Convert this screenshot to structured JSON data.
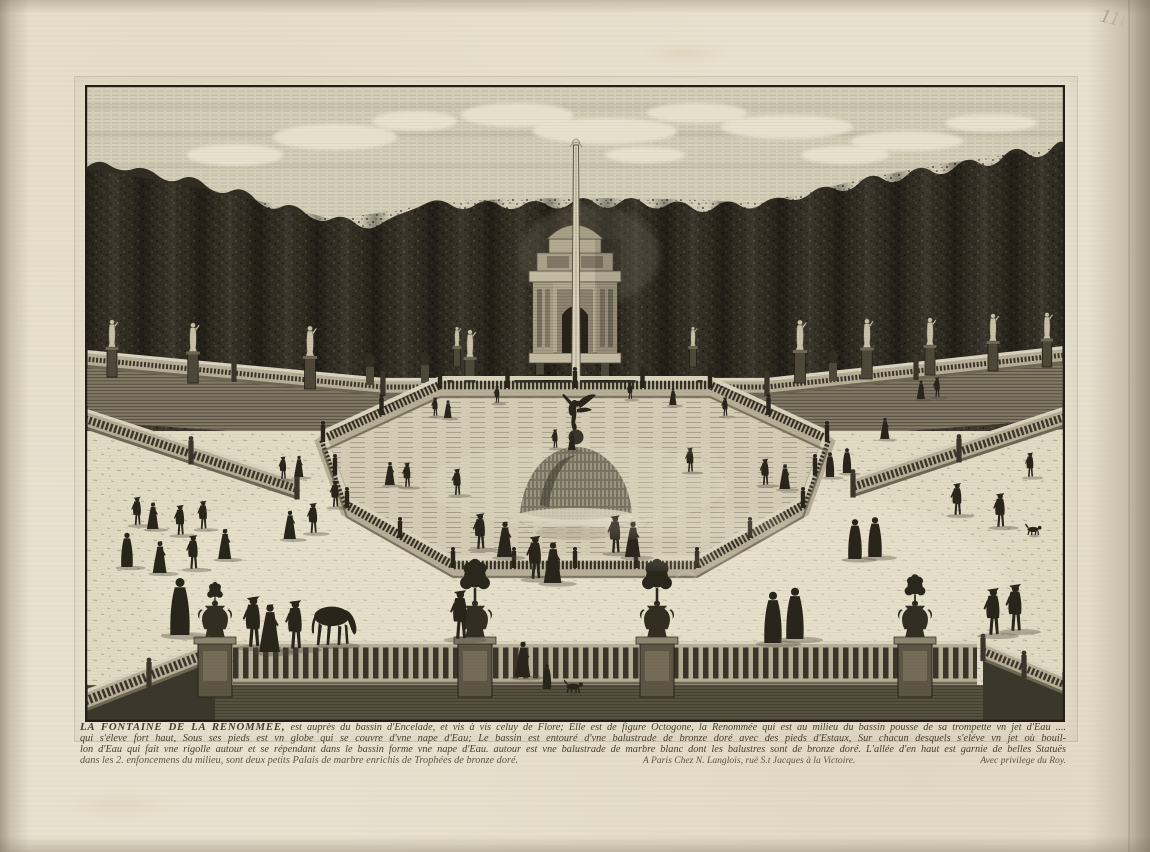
{
  "artwork": {
    "caption": {
      "line1_lead": "LA FONTAINE DE LA RENOMMEE,",
      "line1_rest": "est auprès du bassin d'Encelade, et vis à vis celuy de Flore; Elle est de figure Octogone, la Renommée qui est au milieu du bassin pousse de sa trompette vn jet d'Eau ....",
      "line2": "qui s'éleve fort haut, Sous ses pieds est vn globe qui se couvre d'vne nape d'Eau; Le bassin est entouré d'vne balustrade de bronze doré avec des pieds d'Estaux, Sur chacun desquels s'eléve vn jet où bouil-",
      "line3": "lon d'Eau qui fait vne rigolle autour et se répendant dans le bassin forme vne nape d'Eau. autour est vne balustrade de marbre blanc dont les balustres sont de bronze doré. L'allée d'en haut est garnie de belles Statuës",
      "line4": "dans les 2. enfoncemens du milieu, sont deux petits Palais de marbre enrichis de Trophées de bronze doré.",
      "publisher": "A Paris Chez N. Langlois, ruë S.t Jacques à la Victoire.",
      "privilege": "Avec privilege du Roy."
    },
    "page_number": "116",
    "watermark_symbol": "©",
    "colors": {
      "paper": "#e8e1cf",
      "plate_paper": "#e4ddc7",
      "ink": "#2a251b",
      "ink_soft": "#3a342a",
      "hedge": "#322d23",
      "sky": "#d6cfb9",
      "cloud": "#eae4d1",
      "stone_light": "#c8bfa7",
      "stone_base": "#b7ae97",
      "coping": "#dad3be",
      "water": "#d4ccb4",
      "walkway": "#e2dbc4",
      "wall": "#837a66",
      "shadow": "#4c463a",
      "marble_statue": "#c9c0a8",
      "pencil": "#958d7b",
      "dome": "#7b7362",
      "foliage": "#2b261c"
    }
  },
  "scene": {
    "clouds": [
      [
        150,
        70,
        48,
        11
      ],
      [
        250,
        52,
        62,
        13
      ],
      [
        330,
        36,
        42,
        10
      ],
      [
        432,
        30,
        56,
        12
      ],
      [
        520,
        46,
        72,
        13
      ],
      [
        612,
        28,
        50,
        10
      ],
      [
        702,
        42,
        66,
        12
      ],
      [
        822,
        56,
        56,
        10
      ],
      [
        906,
        38,
        46,
        9
      ],
      [
        560,
        70,
        40,
        8
      ],
      [
        760,
        70,
        44,
        9
      ]
    ],
    "rails_far": [
      [
        0,
        274,
        298,
        302,
        12,
        "2 1.7"
      ],
      [
        298,
        302,
        432,
        302,
        12,
        "2 1.7"
      ],
      [
        548,
        302,
        682,
        302,
        12,
        "2 1.7"
      ],
      [
        682,
        302,
        980,
        270,
        12,
        "2 1.7"
      ]
    ],
    "rails_near": [
      [
        0,
        334,
        212,
        404,
        15,
        "2.4 2"
      ],
      [
        980,
        332,
        768,
        402,
        15,
        "2.4 2"
      ]
    ],
    "rails_fg": [
      [
        148,
        578,
        892,
        578,
        38,
        "5.5 4.5",
        0
      ],
      [
        0,
        616,
        128,
        566,
        16,
        "2.6 2.2",
        1
      ],
      [
        898,
        566,
        980,
        600,
        14,
        "2.4 2",
        1
      ]
    ],
    "basin": [
      [
        355,
        302
      ],
      [
        625,
        302
      ],
      [
        742,
        356
      ],
      [
        718,
        422
      ],
      [
        612,
        482
      ],
      [
        368,
        482
      ],
      [
        262,
        422
      ],
      [
        238,
        356
      ]
    ],
    "statues": [
      [
        27,
        292,
        1.0
      ],
      [
        108,
        298,
        1.05
      ],
      [
        225,
        304,
        1.1
      ],
      [
        385,
        302,
        1.0
      ],
      [
        455,
        290,
        0.85
      ],
      [
        372,
        282,
        0.7
      ],
      [
        608,
        282,
        0.7
      ],
      [
        715,
        298,
        1.1
      ],
      [
        782,
        294,
        1.05
      ],
      [
        845,
        290,
        1.0
      ],
      [
        908,
        286,
        1.0
      ],
      [
        962,
        282,
        0.95
      ]
    ],
    "urnposts": [
      [
        285,
        300
      ],
      [
        340,
        298
      ],
      [
        520,
        292
      ],
      [
        748,
        296
      ]
    ],
    "piers": [
      [
        130,
        "plant"
      ],
      [
        390,
        "tree"
      ],
      [
        572,
        "tree"
      ],
      [
        830,
        "shrub"
      ]
    ],
    "figures": [
      [
        350,
        331,
        20,
        "m"
      ],
      [
        363,
        333,
        20,
        "w"
      ],
      [
        412,
        318,
        18,
        "m"
      ],
      [
        545,
        314,
        18,
        "m"
      ],
      [
        588,
        320,
        19,
        "w"
      ],
      [
        640,
        331,
        20,
        "m"
      ],
      [
        470,
        363,
        20,
        "m"
      ],
      [
        487,
        365,
        20,
        "w"
      ],
      [
        836,
        314,
        21,
        "w"
      ],
      [
        852,
        312,
        21,
        "m"
      ],
      [
        800,
        354,
        24,
        "w"
      ],
      [
        945,
        392,
        26,
        "m"
      ],
      [
        198,
        394,
        24,
        "m"
      ],
      [
        214,
        392,
        24,
        "w"
      ],
      [
        305,
        400,
        26,
        "w"
      ],
      [
        322,
        402,
        26,
        "m"
      ],
      [
        250,
        422,
        28,
        "m"
      ],
      [
        605,
        387,
        26,
        "m"
      ],
      [
        680,
        400,
        28,
        "m"
      ],
      [
        700,
        404,
        28,
        "w"
      ],
      [
        745,
        392,
        26,
        "c"
      ],
      [
        762,
        388,
        26,
        "c"
      ],
      [
        52,
        440,
        30,
        "m"
      ],
      [
        68,
        444,
        30,
        "w"
      ],
      [
        95,
        450,
        32,
        "m"
      ],
      [
        118,
        444,
        30,
        "m"
      ],
      [
        42,
        482,
        36,
        "c"
      ],
      [
        75,
        488,
        36,
        "w"
      ],
      [
        108,
        484,
        36,
        "m"
      ],
      [
        140,
        474,
        34,
        "w"
      ],
      [
        205,
        454,
        32,
        "w"
      ],
      [
        228,
        448,
        32,
        "m"
      ],
      [
        372,
        410,
        28,
        "m"
      ],
      [
        872,
        430,
        34,
        "m"
      ],
      [
        915,
        442,
        36,
        "m"
      ],
      [
        948,
        450,
        12,
        "d"
      ],
      [
        530,
        468,
        40,
        "m"
      ],
      [
        548,
        472,
        40,
        "w"
      ],
      [
        420,
        472,
        40,
        "w"
      ],
      [
        395,
        464,
        38,
        "m"
      ],
      [
        770,
        474,
        42,
        "c"
      ],
      [
        790,
        472,
        42,
        "c"
      ],
      [
        95,
        550,
        60,
        "c"
      ],
      [
        168,
        562,
        54,
        "m"
      ],
      [
        185,
        567,
        54,
        "w"
      ],
      [
        210,
        564,
        52,
        "m"
      ],
      [
        248,
        560,
        52,
        "h"
      ],
      [
        375,
        554,
        52,
        "m"
      ],
      [
        450,
        494,
        46,
        "m"
      ],
      [
        468,
        498,
        46,
        "w"
      ],
      [
        438,
        592,
        40,
        "w"
      ],
      [
        462,
        604,
        26,
        "c"
      ],
      [
        488,
        608,
        14,
        "d"
      ],
      [
        688,
        558,
        54,
        "c"
      ],
      [
        710,
        554,
        54,
        "c"
      ],
      [
        908,
        550,
        50,
        "m"
      ],
      [
        930,
        546,
        50,
        "m"
      ]
    ]
  }
}
